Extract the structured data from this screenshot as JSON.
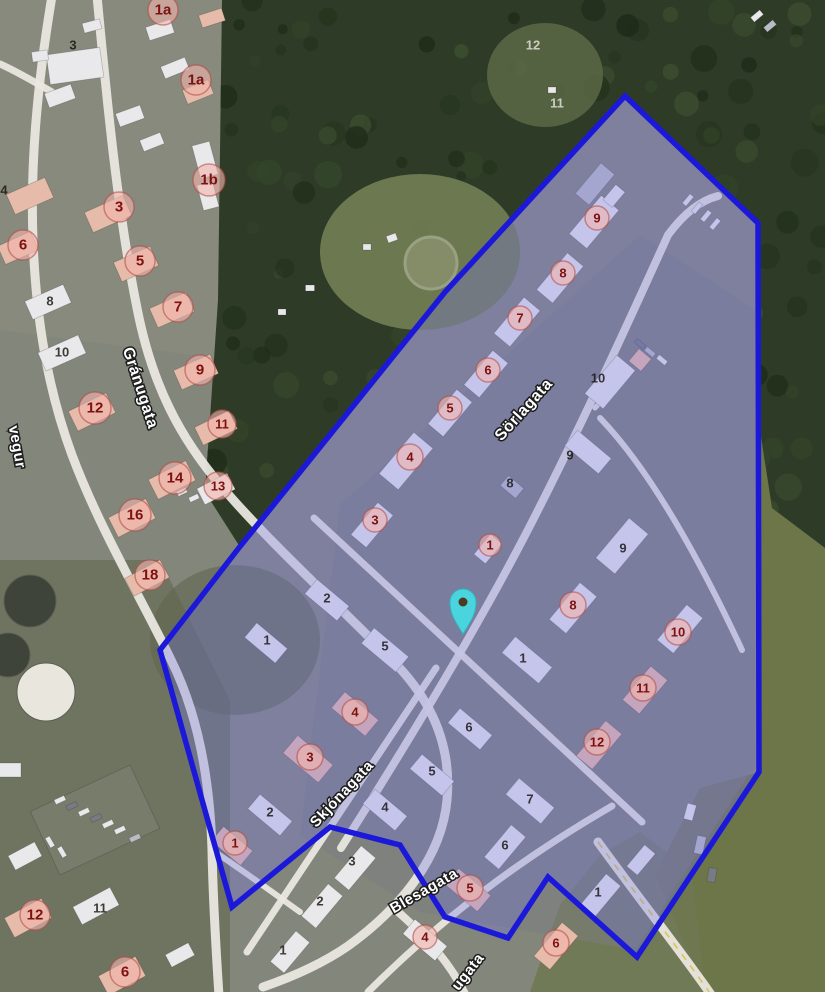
{
  "map": {
    "palette": {
      "base": "#83867b",
      "forest": "#2e3c27",
      "tree_tones": [
        "#24331d",
        "#33452a",
        "#1e2b18",
        "#3d4f30"
      ],
      "field": "#6d7649",
      "clearing": "#707b52",
      "urban": "#7b7b82",
      "scrub": "#5c644c",
      "road": "#e9e7df",
      "highway_dash": "#d9c658",
      "building_w": "#e9e9ec",
      "building_p": "#e7bba9",
      "building_g": "#b9bcc4",
      "building_d": "#777b84",
      "lot": "#787c6a",
      "zone_fill": "rgba(115,115,235,0.30)",
      "zone_stroke": "#1b18da",
      "marker_fill": "#f0b4ae",
      "marker_ring": "#b0473f",
      "marker_text": "#7c1210",
      "label_dark": "#16140e",
      "label_light": "#d9d9d0",
      "street_text": "#ffffff",
      "street_halo": "#1c1c1c",
      "pin_fill": "#4ad5de",
      "pin_stroke": "#2fb6c0",
      "pin_dot": "#4a3b22",
      "tank_dark": "#3f443a",
      "tank_white": "#e9e7dd"
    },
    "terrain_patches": [
      {
        "d": "M0,0 L230,0 L230,360 L0,330 Z",
        "fill": "#8a8d7e",
        "op": 0.6
      },
      {
        "d": "M0,560 L160,560 L230,700 L230,992 L0,992 Z",
        "fill": "#666c57",
        "op": 0.7
      },
      {
        "d": "M760,430 L772,508 L825,548 L825,992 L705,992 L655,875 L700,788 L759,772 Z",
        "fill": "#6d7649",
        "op": 1
      },
      {
        "d": "M530,992 L705,992 L692,872 L640,832 L600,855 L560,905 Z",
        "fill": "#6f7850",
        "op": 0.85
      },
      {
        "d": "M340,505 L640,235 L755,310 L755,765 L635,950 L420,912 L300,835 Z",
        "fill": "#7b7b82",
        "op": 0.5
      }
    ],
    "forest_outline": "M222,0 L825,0 L825,548 L772,508 L760,430 L760,226 L625,96 L447,290 L240,547 L205,492 L218,300 Z",
    "clearings": [
      {
        "cx": 420,
        "cy": 252,
        "rx": 100,
        "ry": 78,
        "fill": "#707b52",
        "op": 0.95
      },
      {
        "cx": 545,
        "cy": 75,
        "rx": 58,
        "ry": 52,
        "fill": "#5c6847",
        "op": 0.85
      },
      {
        "cx": 235,
        "cy": 640,
        "rx": 85,
        "ry": 75,
        "fill": "#5c644c",
        "op": 0.55
      }
    ],
    "ring_feature": {
      "cx": 431,
      "cy": 263,
      "r": 26,
      "stroke": "#99a183",
      "fill": "#848c68"
    },
    "tanks": [
      {
        "cx": 30,
        "cy": 601,
        "r": 26,
        "c": "tank_dark"
      },
      {
        "cx": 8,
        "cy": 655,
        "r": 22,
        "c": "tank_dark"
      },
      {
        "cx": 46,
        "cy": 692,
        "r": 29,
        "c": "tank_white"
      }
    ],
    "roads": [
      {
        "d": "M52,-4 C38,80 30,160 33,240 C36,320 48,390 72,455 C100,530 145,605 172,662 C198,715 210,780 212,850 C213,900 216,950 219,996",
        "w": 9
      },
      {
        "d": "M0,64 C18,72 38,84 52,92",
        "w": 7
      },
      {
        "d": "M97,-4 C106,90 117,210 137,308 C152,385 180,438 222,487 C268,541 335,602 392,660 C432,700 452,746 447,800 C442,856 402,907 348,946 C322,964 292,977 263,987",
        "w": 9
      },
      {
        "d": "M396,910 C430,940 452,966 466,996",
        "w": 8
      },
      {
        "d": "M212,850 C245,872 272,892 300,912",
        "w": 6
      },
      {
        "d": "M341,848 C400,755 470,640 520,545 C570,450 625,330 668,235 C685,212 702,200 718,196",
        "w": 8
      },
      {
        "d": "M247,952 L436,668",
        "w": 7
      },
      {
        "d": "M314,518 L642,822",
        "w": 7
      },
      {
        "d": "M600,418 C650,470 700,560 742,650",
        "w": 6
      },
      {
        "d": "M368,992 C430,930 505,868 612,806",
        "w": 7
      },
      {
        "d": "M598,842 C640,900 680,950 712,996",
        "w": 9,
        "hw": 1
      },
      {
        "d": "M595,408 L628,372",
        "w": 5
      }
    ],
    "buildings": [
      [
        75,
        66,
        54,
        30,
        -8,
        "w"
      ],
      [
        40,
        56,
        16,
        10,
        -8,
        "w"
      ],
      [
        92,
        26,
        18,
        10,
        -15,
        "w"
      ],
      [
        160,
        30,
        26,
        14,
        -18,
        "w"
      ],
      [
        212,
        18,
        24,
        13,
        -18,
        "p"
      ],
      [
        60,
        96,
        28,
        15,
        -20,
        "w"
      ],
      [
        130,
        116,
        26,
        14,
        -20,
        "w"
      ],
      [
        152,
        142,
        22,
        12,
        -22,
        "w"
      ],
      [
        198,
        92,
        28,
        15,
        -22,
        "p"
      ],
      [
        175,
        68,
        26,
        13,
        -22,
        "w"
      ],
      [
        205,
        160,
        18,
        34,
        -15,
        "w"
      ],
      [
        208,
        196,
        16,
        26,
        -15,
        "w"
      ],
      [
        30,
        196,
        42,
        22,
        -24,
        "p"
      ],
      [
        18,
        248,
        36,
        20,
        -24,
        "p"
      ],
      [
        108,
        214,
        42,
        22,
        -24,
        "p"
      ],
      [
        136,
        264,
        40,
        21,
        -24,
        "p"
      ],
      [
        48,
        302,
        42,
        20,
        -24,
        "w"
      ],
      [
        62,
        353,
        44,
        20,
        -24,
        "w"
      ],
      [
        172,
        310,
        40,
        21,
        -24,
        "p"
      ],
      [
        196,
        372,
        40,
        21,
        -24,
        "p"
      ],
      [
        92,
        412,
        42,
        22,
        -26,
        "p"
      ],
      [
        216,
        428,
        38,
        20,
        -26,
        "p"
      ],
      [
        172,
        480,
        42,
        22,
        -27,
        "p"
      ],
      [
        216,
        489,
        34,
        18,
        -27,
        "w"
      ],
      [
        132,
        518,
        42,
        22,
        -27,
        "p"
      ],
      [
        147,
        578,
        40,
        20,
        -28,
        "p"
      ],
      [
        95,
        820,
        110,
        70,
        -25,
        "lot"
      ],
      [
        60,
        800,
        11,
        5,
        -25,
        "w"
      ],
      [
        72,
        806,
        11,
        5,
        -25,
        "d"
      ],
      [
        84,
        812,
        11,
        5,
        -25,
        "w"
      ],
      [
        96,
        818,
        11,
        5,
        -25,
        "d"
      ],
      [
        108,
        824,
        11,
        5,
        -25,
        "w"
      ],
      [
        120,
        830,
        11,
        5,
        -25,
        "w"
      ],
      [
        135,
        838,
        11,
        5,
        -25,
        "g"
      ],
      [
        50,
        842,
        11,
        5,
        60,
        "w"
      ],
      [
        62,
        852,
        11,
        5,
        60,
        "w"
      ],
      [
        182,
        492,
        10,
        5,
        -25,
        "w"
      ],
      [
        194,
        498,
        10,
        5,
        -25,
        "w"
      ],
      [
        25,
        856,
        30,
        16,
        -28,
        "w"
      ],
      [
        28,
        918,
        42,
        22,
        -28,
        "p"
      ],
      [
        96,
        906,
        42,
        20,
        -28,
        "w"
      ],
      [
        122,
        976,
        42,
        22,
        -28,
        "p"
      ],
      [
        180,
        955,
        26,
        14,
        -28,
        "w"
      ],
      [
        8,
        770,
        26,
        14,
        0,
        "w"
      ],
      [
        594,
        222,
        50,
        23,
        -50,
        "w"
      ],
      [
        614,
        196,
        20,
        12,
        -50,
        "w"
      ],
      [
        560,
        278,
        48,
        21,
        -50,
        "w"
      ],
      [
        517,
        322,
        47,
        21,
        -50,
        "w"
      ],
      [
        486,
        374,
        45,
        20,
        -50,
        "w"
      ],
      [
        450,
        413,
        45,
        20,
        -50,
        "w"
      ],
      [
        406,
        461,
        54,
        25,
        -50,
        "w"
      ],
      [
        372,
        525,
        42,
        20,
        -50,
        "w"
      ],
      [
        488,
        549,
        26,
        15,
        -50,
        "w"
      ],
      [
        610,
        382,
        50,
        24,
        -50,
        "w"
      ],
      [
        640,
        360,
        16,
        16,
        -50,
        "p"
      ],
      [
        588,
        452,
        44,
        20,
        40,
        "w"
      ],
      [
        512,
        487,
        20,
        13,
        40,
        "g"
      ],
      [
        622,
        546,
        52,
        25,
        -50,
        "w"
      ],
      [
        573,
        608,
        48,
        22,
        -50,
        "w"
      ],
      [
        680,
        629,
        46,
        21,
        -50,
        "w"
      ],
      [
        645,
        690,
        44,
        22,
        -50,
        "p"
      ],
      [
        599,
        745,
        46,
        21,
        -50,
        "p"
      ],
      [
        527,
        660,
        48,
        21,
        40,
        "w"
      ],
      [
        385,
        650,
        45,
        20,
        40,
        "w"
      ],
      [
        327,
        600,
        42,
        19,
        40,
        "w"
      ],
      [
        266,
        643,
        40,
        19,
        40,
        "w"
      ],
      [
        355,
        714,
        44,
        21,
        40,
        "p"
      ],
      [
        308,
        759,
        46,
        23,
        40,
        "p"
      ],
      [
        270,
        815,
        42,
        19,
        40,
        "w"
      ],
      [
        232,
        846,
        38,
        19,
        40,
        "p"
      ],
      [
        432,
        775,
        42,
        19,
        40,
        "w"
      ],
      [
        385,
        810,
        42,
        19,
        40,
        "w"
      ],
      [
        470,
        729,
        42,
        19,
        40,
        "w"
      ],
      [
        530,
        801,
        46,
        21,
        40,
        "w"
      ],
      [
        468,
        890,
        42,
        21,
        40,
        "p"
      ],
      [
        425,
        940,
        42,
        19,
        40,
        "w"
      ],
      [
        355,
        868,
        42,
        19,
        -50,
        "w"
      ],
      [
        322,
        906,
        42,
        19,
        -50,
        "w"
      ],
      [
        290,
        952,
        40,
        18,
        -50,
        "w"
      ],
      [
        505,
        847,
        42,
        19,
        -50,
        "w"
      ],
      [
        556,
        946,
        44,
        21,
        -50,
        "p"
      ],
      [
        600,
        896,
        42,
        19,
        -50,
        "w"
      ],
      [
        641,
        860,
        28,
        14,
        -50,
        "w"
      ],
      [
        595,
        184,
        40,
        18,
        -50,
        "g"
      ],
      [
        688,
        200,
        12,
        5,
        -50,
        "w"
      ],
      [
        697,
        208,
        12,
        5,
        -50,
        "w"
      ],
      [
        706,
        216,
        12,
        5,
        -50,
        "w"
      ],
      [
        715,
        224,
        12,
        5,
        -50,
        "w"
      ],
      [
        650,
        352,
        11,
        5,
        40,
        "g"
      ],
      [
        662,
        360,
        11,
        5,
        40,
        "w"
      ],
      [
        640,
        344,
        11,
        5,
        40,
        "d"
      ],
      [
        690,
        812,
        9,
        16,
        15,
        "w"
      ],
      [
        700,
        845,
        9,
        18,
        12,
        "g"
      ],
      [
        712,
        875,
        8,
        14,
        10,
        "d"
      ],
      [
        757,
        16,
        12,
        6,
        -40,
        "w"
      ],
      [
        770,
        26,
        12,
        6,
        -40,
        "g"
      ],
      [
        392,
        238,
        10,
        7,
        -20,
        "w"
      ],
      [
        367,
        247,
        8,
        6,
        0,
        "w"
      ],
      [
        310,
        288,
        9,
        6,
        0,
        "w"
      ],
      [
        282,
        312,
        8,
        6,
        0,
        "w"
      ],
      [
        552,
        90,
        8,
        6,
        0,
        "w"
      ]
    ],
    "zone_polygon": {
      "points": [
        [
          625,
          96
        ],
        [
          758,
          223
        ],
        [
          759,
          772
        ],
        [
          637,
          957
        ],
        [
          548,
          877
        ],
        [
          508,
          938
        ],
        [
          445,
          917
        ],
        [
          400,
          845
        ],
        [
          330,
          827
        ],
        [
          232,
          907
        ],
        [
          160,
          650
        ],
        [
          238,
          549
        ],
        [
          445,
          292
        ]
      ],
      "stroke_width": 5.5
    },
    "street_labels": [
      {
        "name": "Gránugata",
        "x": 140,
        "y": 388,
        "rot": 72,
        "size": 16
      },
      {
        "name": "Sörlagata",
        "x": 524,
        "y": 410,
        "rot": -48,
        "size": 16
      },
      {
        "name": "Skjónagata",
        "x": 342,
        "y": 794,
        "rot": -47,
        "size": 15
      },
      {
        "name": "Blesagata",
        "x": 424,
        "y": 891,
        "rot": -30,
        "size": 15
      },
      {
        "name": "vegur",
        "x": 17,
        "y": 447,
        "rot": 80,
        "size": 15
      },
      {
        "name": "ugata",
        "x": 468,
        "y": 972,
        "rot": -52,
        "size": 15
      }
    ],
    "lot_labels": [
      {
        "t": "3",
        "x": 73,
        "y": 45
      },
      {
        "t": "4",
        "x": 4,
        "y": 190
      },
      {
        "t": "8",
        "x": 50,
        "y": 301
      },
      {
        "t": "10",
        "x": 62,
        "y": 352
      },
      {
        "t": "12",
        "x": 533,
        "y": 45,
        "light": 1
      },
      {
        "t": "11",
        "x": 557,
        "y": 103,
        "light": 1
      },
      {
        "t": "11",
        "x": 100,
        "y": 908
      },
      {
        "t": "2",
        "x": 327,
        "y": 598
      },
      {
        "t": "1",
        "x": 267,
        "y": 640
      },
      {
        "t": "5",
        "x": 385,
        "y": 646
      },
      {
        "t": "1",
        "x": 523,
        "y": 658
      },
      {
        "t": "6",
        "x": 469,
        "y": 727
      },
      {
        "t": "5",
        "x": 432,
        "y": 771
      },
      {
        "t": "4",
        "x": 385,
        "y": 807
      },
      {
        "t": "7",
        "x": 530,
        "y": 799
      },
      {
        "t": "2",
        "x": 270,
        "y": 812
      },
      {
        "t": "10",
        "x": 598,
        "y": 378
      },
      {
        "t": "9",
        "x": 570,
        "y": 455
      },
      {
        "t": "8",
        "x": 510,
        "y": 483
      },
      {
        "t": "9",
        "x": 623,
        "y": 548
      },
      {
        "t": "3",
        "x": 352,
        "y": 861
      },
      {
        "t": "2",
        "x": 320,
        "y": 901
      },
      {
        "t": "6",
        "x": 505,
        "y": 845
      },
      {
        "t": "1",
        "x": 598,
        "y": 892
      },
      {
        "t": "1",
        "x": 283,
        "y": 950
      }
    ],
    "red_markers": [
      {
        "t": "1a",
        "x": 163,
        "y": 10,
        "r": 15
      },
      {
        "t": "1a",
        "x": 196,
        "y": 80,
        "r": 15
      },
      {
        "t": "1b",
        "x": 209,
        "y": 180,
        "r": 16
      },
      {
        "t": "3",
        "x": 119,
        "y": 207,
        "r": 15
      },
      {
        "t": "6",
        "x": 23,
        "y": 245,
        "r": 15
      },
      {
        "t": "5",
        "x": 140,
        "y": 261,
        "r": 15
      },
      {
        "t": "7",
        "x": 178,
        "y": 307,
        "r": 15
      },
      {
        "t": "9",
        "x": 200,
        "y": 370,
        "r": 15
      },
      {
        "t": "12",
        "x": 95,
        "y": 408,
        "r": 16
      },
      {
        "t": "11",
        "x": 222,
        "y": 424,
        "r": 14
      },
      {
        "t": "14",
        "x": 175,
        "y": 478,
        "r": 16
      },
      {
        "t": "13",
        "x": 218,
        "y": 486,
        "r": 14
      },
      {
        "t": "16",
        "x": 135,
        "y": 515,
        "r": 16
      },
      {
        "t": "18",
        "x": 150,
        "y": 575,
        "r": 15
      },
      {
        "t": "12",
        "x": 35,
        "y": 915,
        "r": 15
      },
      {
        "t": "6",
        "x": 125,
        "y": 972,
        "r": 15
      },
      {
        "t": "9",
        "x": 597,
        "y": 218,
        "r": 12
      },
      {
        "t": "8",
        "x": 563,
        "y": 273,
        "r": 12
      },
      {
        "t": "7",
        "x": 520,
        "y": 318,
        "r": 12
      },
      {
        "t": "6",
        "x": 488,
        "y": 370,
        "r": 12
      },
      {
        "t": "5",
        "x": 450,
        "y": 408,
        "r": 12
      },
      {
        "t": "4",
        "x": 410,
        "y": 457,
        "r": 13
      },
      {
        "t": "3",
        "x": 375,
        "y": 520,
        "r": 12
      },
      {
        "t": "1",
        "x": 490,
        "y": 545,
        "r": 11
      },
      {
        "t": "8",
        "x": 573,
        "y": 605,
        "r": 13
      },
      {
        "t": "10",
        "x": 678,
        "y": 632,
        "r": 13
      },
      {
        "t": "11",
        "x": 643,
        "y": 688,
        "r": 13
      },
      {
        "t": "12",
        "x": 597,
        "y": 742,
        "r": 13
      },
      {
        "t": "4",
        "x": 355,
        "y": 712,
        "r": 13
      },
      {
        "t": "3",
        "x": 310,
        "y": 757,
        "r": 13
      },
      {
        "t": "1",
        "x": 235,
        "y": 843,
        "r": 12
      },
      {
        "t": "5",
        "x": 470,
        "y": 888,
        "r": 13
      },
      {
        "t": "4",
        "x": 425,
        "y": 937,
        "r": 12
      },
      {
        "t": "6",
        "x": 556,
        "y": 943,
        "r": 13
      }
    ],
    "pin": {
      "x": 463,
      "y": 601
    }
  }
}
